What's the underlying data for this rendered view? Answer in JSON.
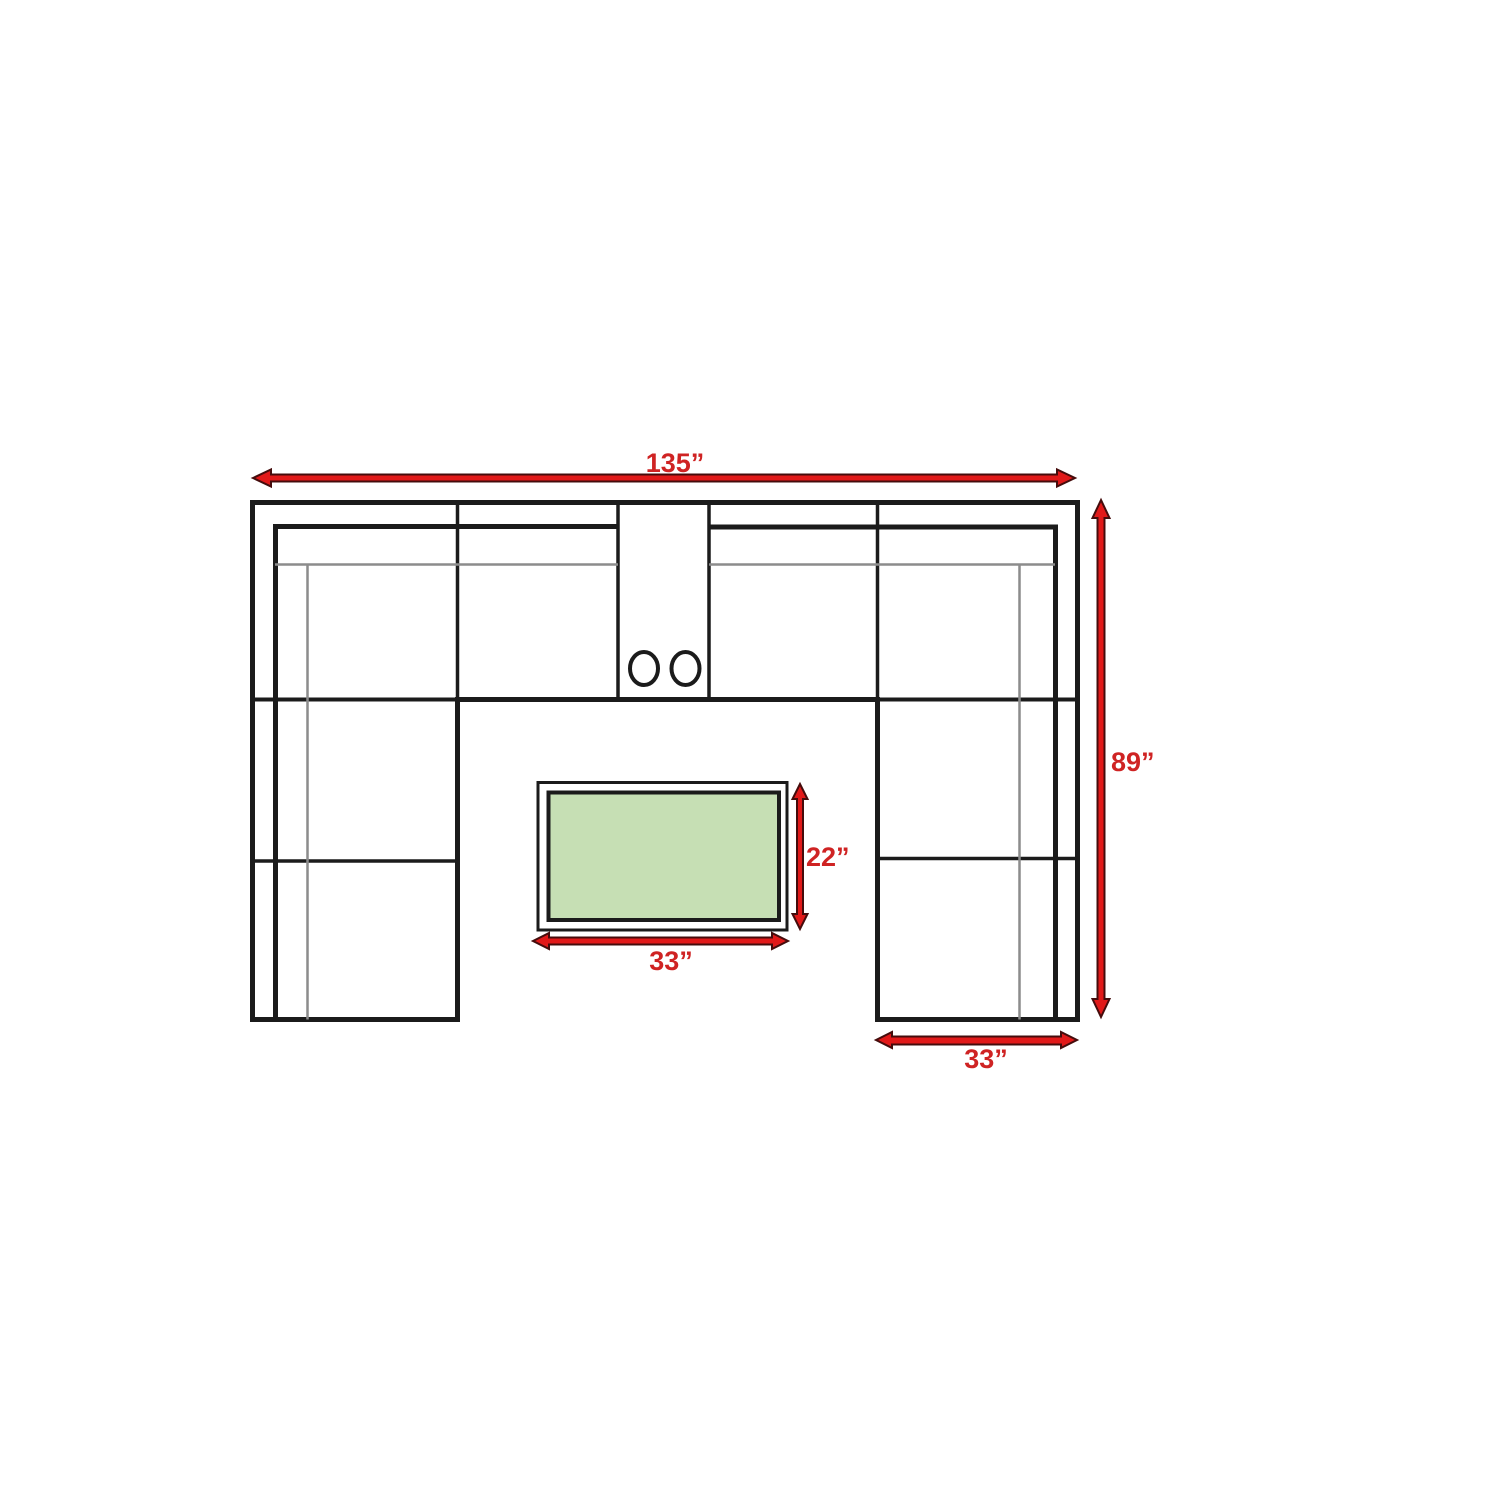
{
  "diagram": {
    "type": "sectional-sofa-floor-plan",
    "labels": {
      "overall_width": "135”",
      "overall_depth": "89”",
      "ottoman_depth": "22”",
      "ottoman_width": "33”",
      "right_section_width": "33”"
    },
    "colors": {
      "arrow_fill": "#e11919",
      "arrow_outline": "#450c0c",
      "label_text": "#cf2323",
      "sofa_outline": "#1b1b1b",
      "cushion_gray": "#8c8c8c",
      "ottoman_fill": "#c6dfb4",
      "background": "#ffffff"
    },
    "icons": {
      "dimension_arrow": "double-headed-arrow-icon",
      "cupholder": "cupholder-circle-icon"
    },
    "counts": {
      "cupholders": 2
    }
  }
}
